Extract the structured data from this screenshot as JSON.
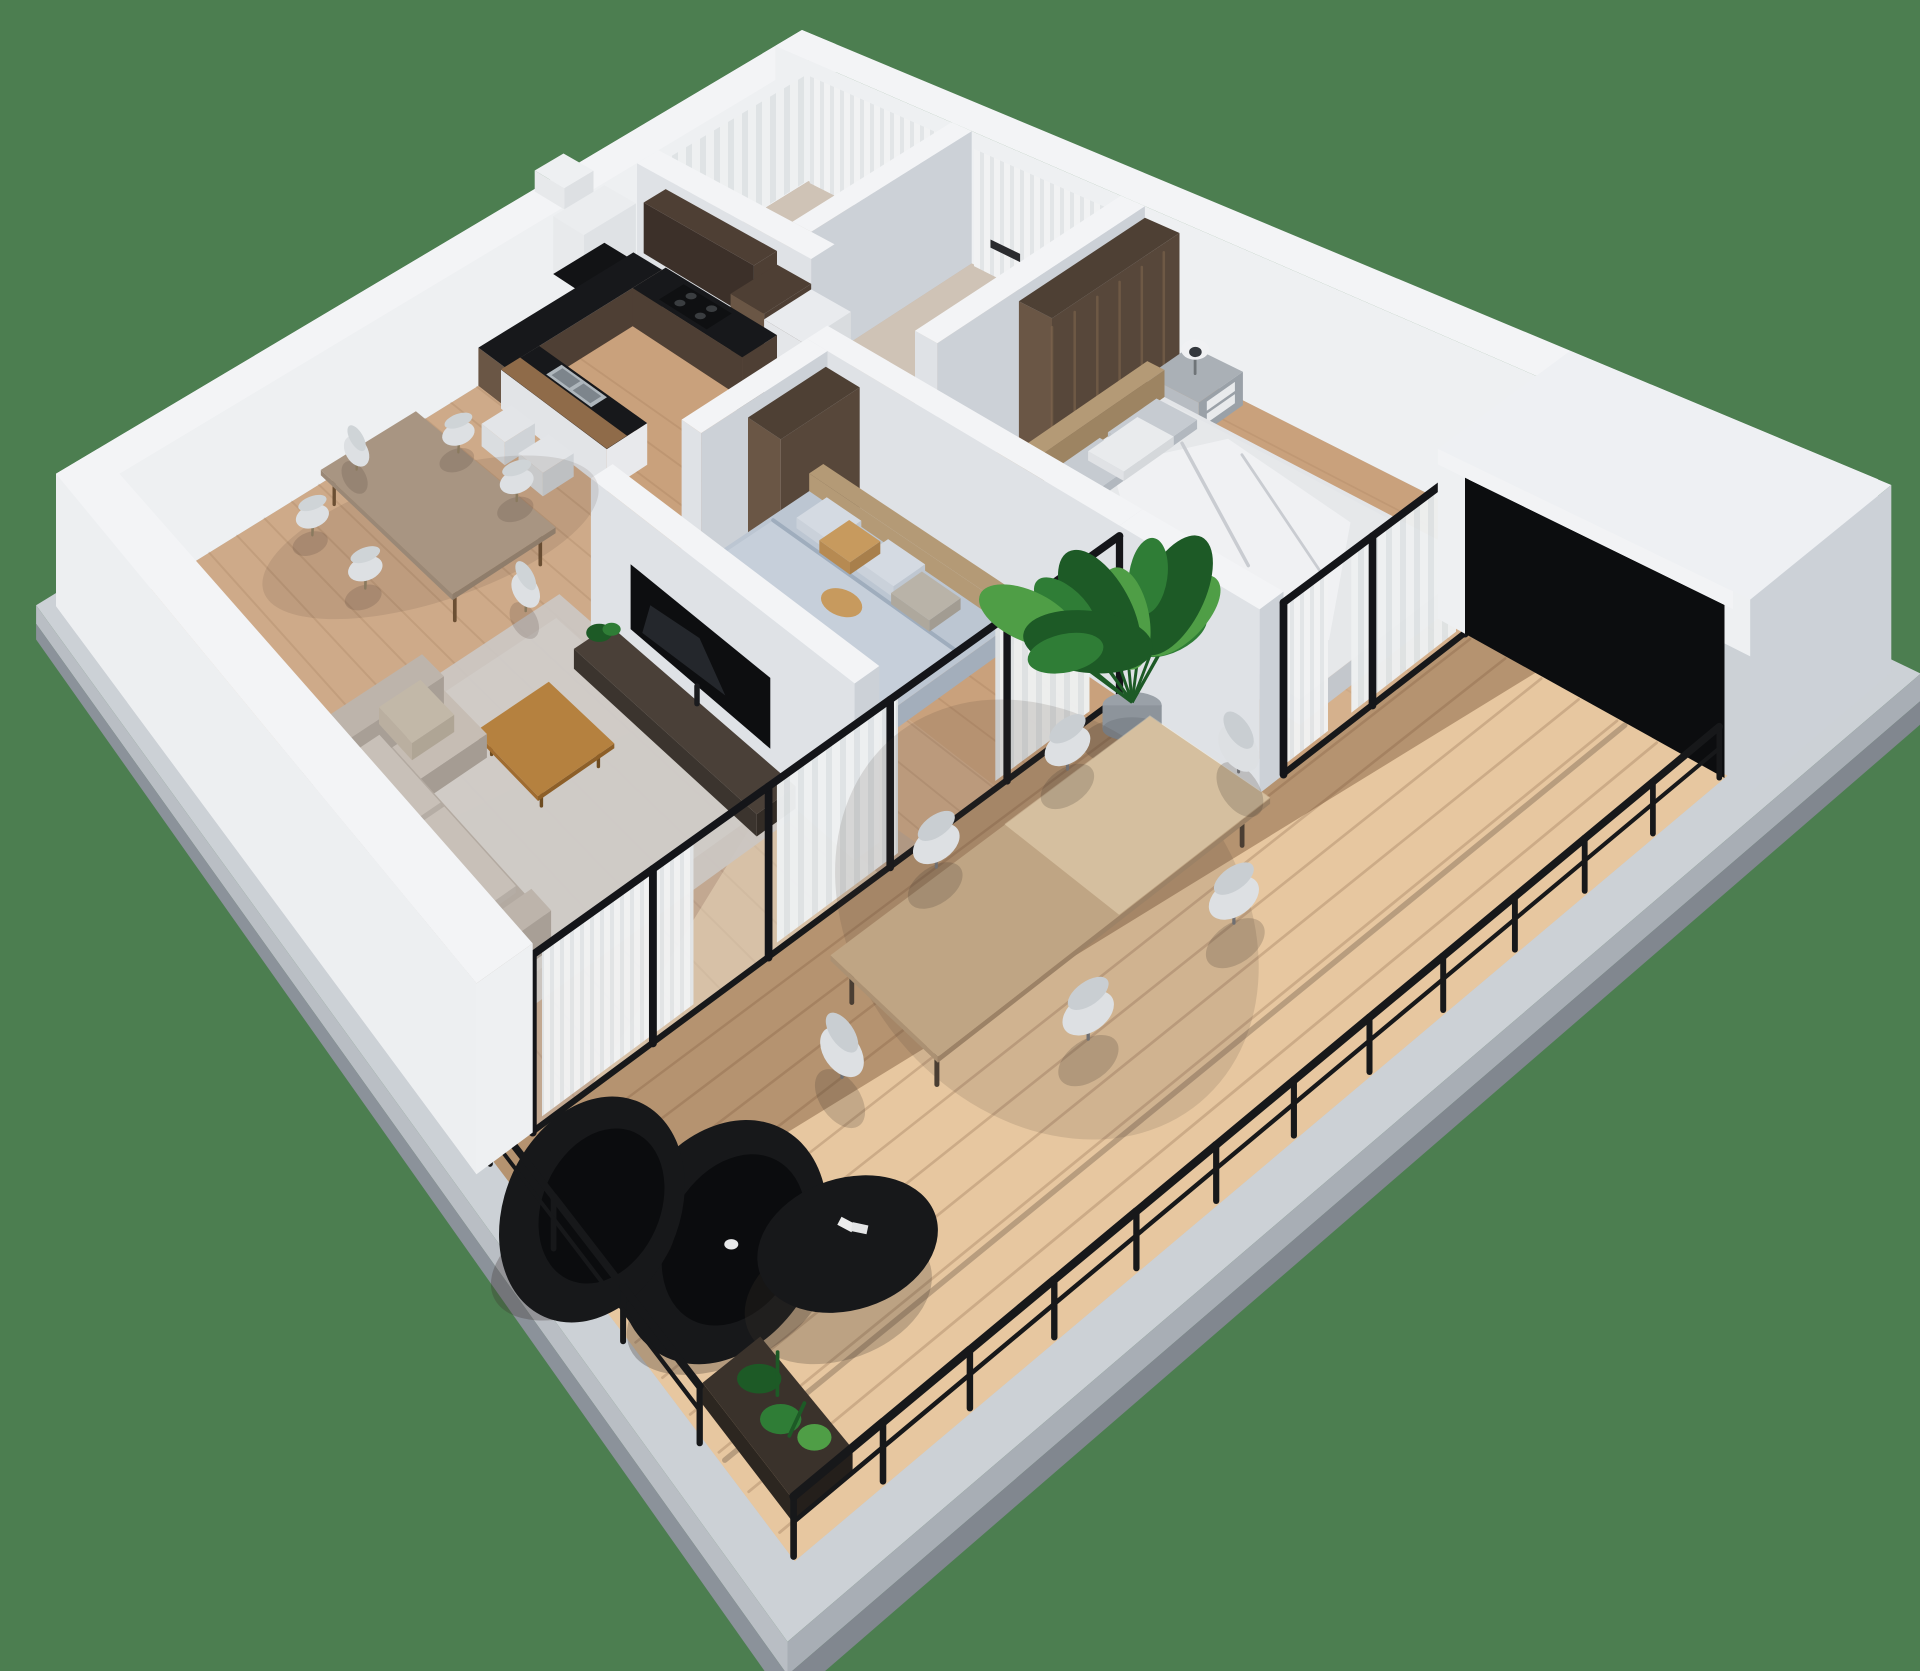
{
  "meta": {
    "title": "Isometric 3D floor plan rendering of a two-bedroom apartment with balcony",
    "view": "3d-isometric-floorplan"
  },
  "palette": {
    "background": "#4c7e50",
    "wall_top": "#f3f4f6",
    "wall_light": "#eef0f2",
    "wall_mid": "#dfe2e6",
    "wall_shadow": "#ccd1d7",
    "wall_outer": "#e8eaed",
    "floor_wood": "#c9a17c",
    "floor_bath": "#cfc3b6",
    "deck": "#d7ae82",
    "counter_black": "#17181b",
    "cabinet_wood": "#4e3f34",
    "cabinet_wood_light": "#6a5645",
    "wardrobe_wood": "#57473a",
    "rug": "#cbc6c2",
    "sofa": "#b3aaa1",
    "sofa_light": "#c6bdb4",
    "table_wood": "#a89582",
    "coffee_table": "#b5813f",
    "tv_black": "#0d0e10",
    "metal_black": "#17181a",
    "bed_small": "#bcc6d2",
    "bed_small_light": "#c6cfda",
    "bed_master": "#e3e5e8",
    "headboard": "#b49a76",
    "nightstand": "#9aa1a8",
    "chair_white": "#dde0e3",
    "curtain": "#eef0f1",
    "plant_green": "#2f7d36",
    "plant_green_dark": "#1d5a26",
    "plant_green_light": "#4f9e46",
    "slab_top": "#ccd1d6",
    "slab_side": "#a8aeb5",
    "slab_dark": "#81878f",
    "glass_dark": "#0c0d0f",
    "accent_pillow": "#c79a5e"
  },
  "scene": {
    "rooms": [
      "bathroom-1",
      "bathroom-2",
      "kitchen",
      "hallway",
      "master-bedroom",
      "small-bedroom",
      "dining-area",
      "living-room",
      "balcony",
      "corner-room"
    ],
    "furniture": [
      "kitchen-counters",
      "range-hood",
      "cooktop",
      "sink",
      "bar-stools",
      "dining-table",
      "dining-chairs",
      "rug",
      "sofa",
      "coffee-table",
      "tv",
      "tv-console",
      "bed-small",
      "bed-master",
      "headboards",
      "nightstand",
      "table-lamp",
      "wardrobes",
      "shower-curtains",
      "monstera-plant",
      "outdoor-dining-table",
      "outdoor-chairs",
      "egg-chairs",
      "outdoor-coffee-table",
      "corner-planter",
      "balcony-railing",
      "glass-wall-mullions",
      "curtains"
    ]
  }
}
